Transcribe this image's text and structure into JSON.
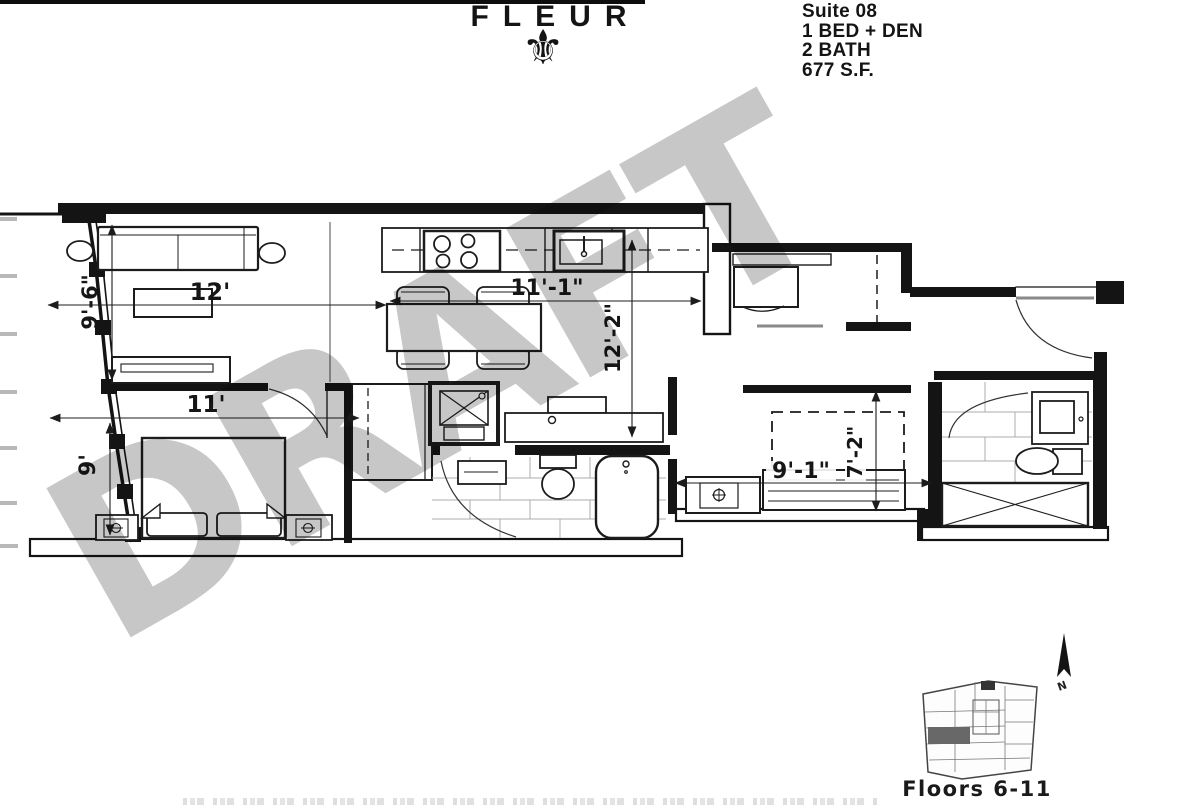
{
  "header": {
    "brand": "FLEUR",
    "fleur_glyph": "⚜",
    "suite_lines": [
      "Suite 08",
      "1 BED + DEN",
      "2 BATH",
      "677 S.F."
    ]
  },
  "watermark": {
    "text": "DRAFT",
    "color": "#c7c7c7"
  },
  "dimensions": {
    "living_width": "12'",
    "living_depth": "9'-6\"",
    "dining_width": "11'-1\"",
    "dining_depth": "12'-2\"",
    "bedroom_width": "11'",
    "bedroom_depth": "9'",
    "den_width": "9'-1\"",
    "den_depth": "7'-2\""
  },
  "keyplan": {
    "caption": "Floors 6-11",
    "north_label": "N",
    "highlight_color": "#686868"
  },
  "colors": {
    "line": "#141414",
    "tile": "#adadad",
    "glass_stub": "#b8b8b8"
  }
}
